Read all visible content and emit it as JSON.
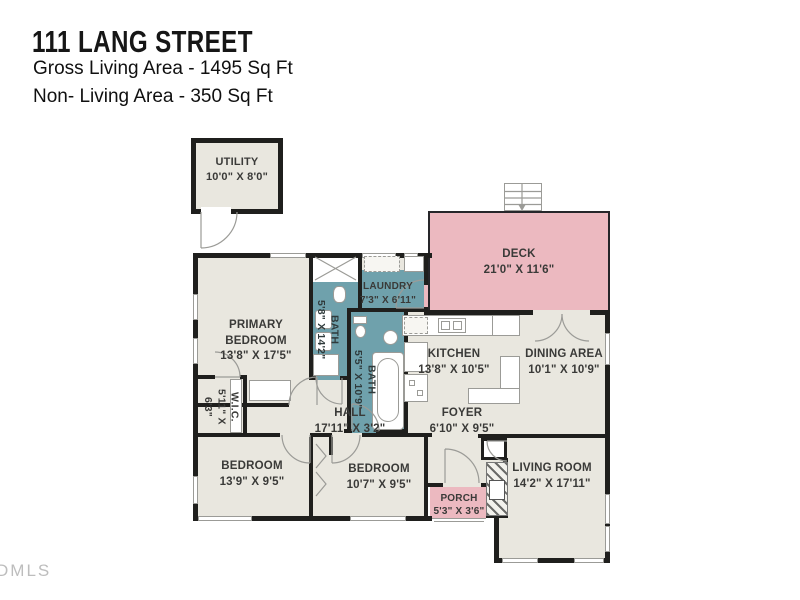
{
  "header": {
    "title": "111 LANG STREET",
    "gross_living": "Gross Living Area - 1495 Sq Ft",
    "non_living": "Non- Living Area - 350 Sq Ft"
  },
  "watermark": "DMLS",
  "colors": {
    "wall": "#1f1f1d",
    "floor": "#e9e7df",
    "wet_rooms": "#6fa1ac",
    "deck_porch": "#ecb9c0",
    "lines": "#9b9b97",
    "label_text": "#3a3a38"
  },
  "rooms": [
    {
      "id": "utility",
      "name": "UTILITY",
      "dims": "10'0\" X 8'0\""
    },
    {
      "id": "deck",
      "name": "DECK",
      "dims": "21'0\" X 11'6\""
    },
    {
      "id": "laundry",
      "name": "LAUNDRY",
      "dims": "7'3\" X 6'11\""
    },
    {
      "id": "bath1",
      "name": "BATH",
      "dims": "5'8\" X 14'2\""
    },
    {
      "id": "primary",
      "name": "PRIMARY BEDROOM",
      "dims": "13'8\" X 17'5\""
    },
    {
      "id": "bath2",
      "name": "BATH",
      "dims": "5'5\" X 10'9\""
    },
    {
      "id": "kitchen",
      "name": "KITCHEN",
      "dims": "13'8\" X 10'5\""
    },
    {
      "id": "dining",
      "name": "DINING AREA",
      "dims": "10'1\" X 10'9\""
    },
    {
      "id": "wic",
      "name": "W.I.C.",
      "dims": "5'11\" X 6'3\""
    },
    {
      "id": "hall",
      "name": "HALL",
      "dims": "17'11\" X 3'2\""
    },
    {
      "id": "foyer",
      "name": "FOYER",
      "dims": "6'10\" X 9'5\""
    },
    {
      "id": "bedroom1",
      "name": "BEDROOM",
      "dims": "13'9\" X 9'5\""
    },
    {
      "id": "bedroom2",
      "name": "BEDROOM",
      "dims": "10'7\" X 9'5\""
    },
    {
      "id": "porch",
      "name": "PORCH",
      "dims": "5'3\" X 3'6\""
    },
    {
      "id": "living",
      "name": "LIVING ROOM",
      "dims": "14'2\" X 17'11\""
    }
  ]
}
